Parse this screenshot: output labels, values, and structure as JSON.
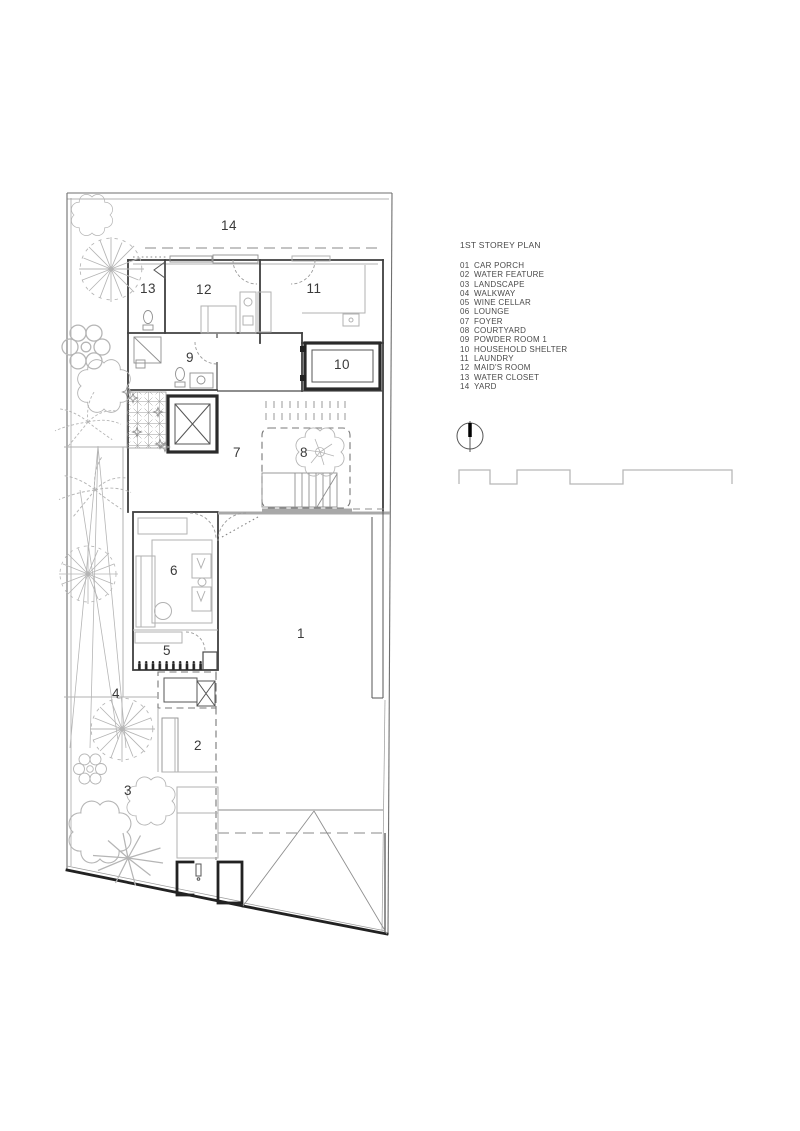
{
  "legend": {
    "title": "1ST STOREY PLAN",
    "items": [
      {
        "num": "01",
        "label": "CAR PORCH"
      },
      {
        "num": "02",
        "label": "WATER FEATURE"
      },
      {
        "num": "03",
        "label": "LANDSCAPE"
      },
      {
        "num": "04",
        "label": "WALKWAY"
      },
      {
        "num": "05",
        "label": "WINE CELLAR"
      },
      {
        "num": "06",
        "label": "LOUNGE"
      },
      {
        "num": "07",
        "label": "FOYER"
      },
      {
        "num": "08",
        "label": "COURTYARD"
      },
      {
        "num": "09",
        "label": "POWDER ROOM 1"
      },
      {
        "num": "10",
        "label": "HOUSEHOLD SHELTER"
      },
      {
        "num": "11",
        "label": "LAUNDRY"
      },
      {
        "num": "12",
        "label": "MAID'S ROOM"
      },
      {
        "num": "13",
        "label": "WATER CLOSET"
      },
      {
        "num": "14",
        "label": "YARD"
      }
    ]
  },
  "plan": {
    "labels": [
      {
        "num": "1",
        "name": "CAR PORCH"
      },
      {
        "num": "2",
        "name": "WATER FEATURE"
      },
      {
        "num": "3",
        "name": "LANDSCAPE"
      },
      {
        "num": "4",
        "name": "WALKWAY"
      },
      {
        "num": "5",
        "name": "WINE CELLAR"
      },
      {
        "num": "6",
        "name": "LOUNGE"
      },
      {
        "num": "7",
        "name": "FOYER"
      },
      {
        "num": "8",
        "name": "COURTYARD"
      },
      {
        "num": "9",
        "name": "POWDER ROOM 1"
      },
      {
        "num": "10",
        "name": "HOUSEHOLD SHELTER"
      },
      {
        "num": "11",
        "name": "LAUNDRY"
      },
      {
        "num": "12",
        "name": "MAID'S ROOM"
      },
      {
        "num": "13",
        "name": "WATER CLOSET"
      },
      {
        "num": "14",
        "name": "YARD"
      }
    ]
  },
  "colors": {
    "wall": "#3f3f3f",
    "thick_wall": "#2a2a2a",
    "light_detail": "#b2b2b2",
    "text": "#4a4a4a",
    "background": "#ffffff"
  }
}
